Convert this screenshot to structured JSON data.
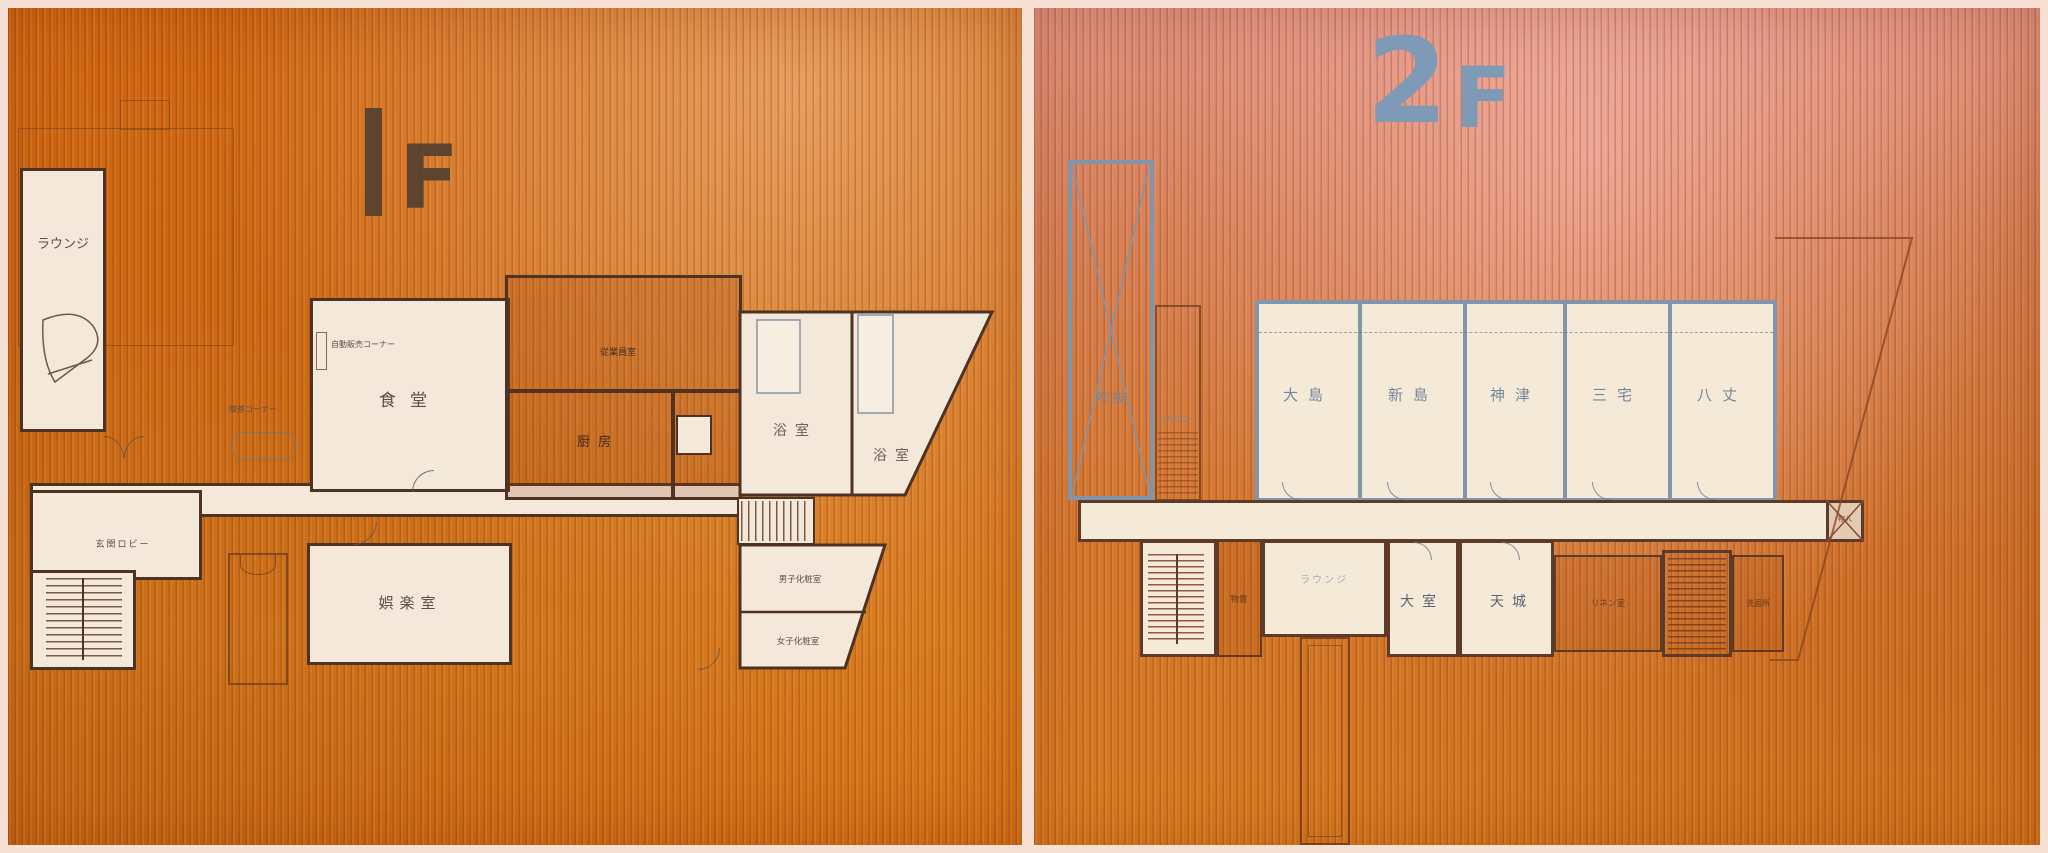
{
  "f1": {
    "num": "1",
    "suf": "F",
    "lounge": "ラウンジ",
    "lobby": "玄関ロビー",
    "dining": "食堂",
    "tea": "喫茶コーナー",
    "vending": "自動販売コーナー",
    "staff": "従業員室",
    "kitchen": "厨房",
    "bath1": "浴室",
    "bath2": "浴室",
    "mens": "男子化粧室",
    "womens": "女子化粧室",
    "recreation": "娯楽室"
  },
  "f2": {
    "num": "2",
    "suf": "F",
    "atrium": "吹抜",
    "balcony": "バルコニー",
    "oshima": "大島",
    "niijima": "新島",
    "kozu": "神津",
    "miyake": "三宅",
    "hachijo": "八丈",
    "lounge": "ラウンジ",
    "storage": "物置",
    "omuro": "大室",
    "amagi": "天城",
    "linen": "リネン室",
    "washroom": "洗面所",
    "closet": "物入"
  },
  "colors": {
    "wood_orange": "#d06a15",
    "wood_rose": "#d68058",
    "wall_brown": "#4f3322",
    "wall_blue": "#8195ac",
    "room_cream": "#f3e8da",
    "title_brown": "#54402f",
    "title_blue": "#7e9ab6",
    "frame_pink": "#f6dfd3"
  }
}
